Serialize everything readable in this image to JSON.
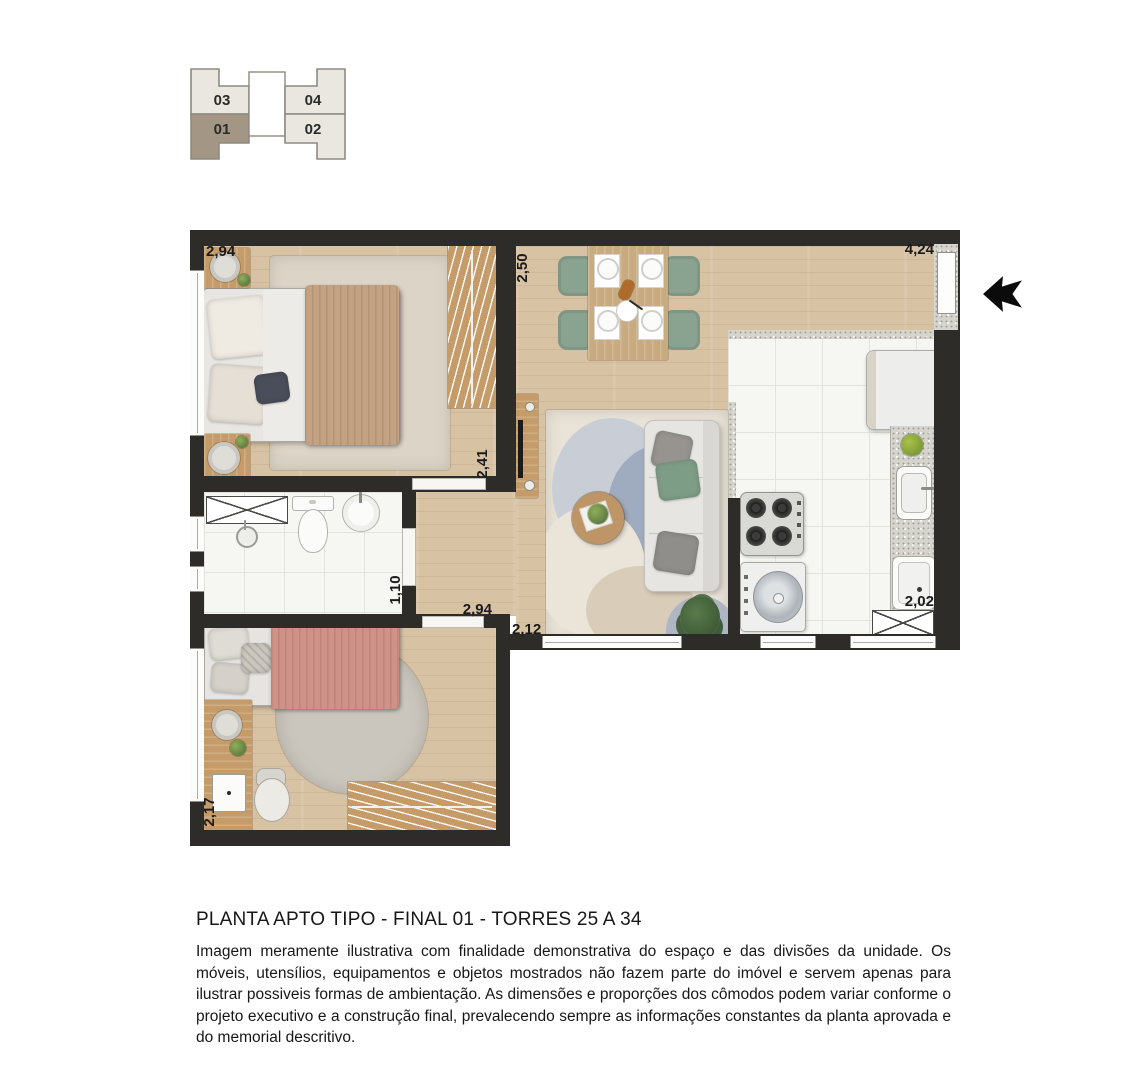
{
  "key_plan": {
    "units": [
      {
        "id": "03",
        "label": "03",
        "highlighted": false
      },
      {
        "id": "04",
        "label": "04",
        "highlighted": false
      },
      {
        "id": "01",
        "label": "01",
        "highlighted": true
      },
      {
        "id": "02",
        "label": "02",
        "highlighted": false
      }
    ],
    "highlight_color": "#A49685",
    "unit_color": "#E9E7E0",
    "border_color": "#8E8A81"
  },
  "floor_plan": {
    "dimensions": {
      "bedroom1_width": "2,94",
      "living_width": "2,50",
      "entry_width": "4,24",
      "bedroom1_length": "2,41",
      "bathroom_width": "1,10",
      "bedroom2_width": "2,94",
      "hall_width": "2,12",
      "kitchen_width": "2,02",
      "bedroom2_length": "2,17"
    },
    "colors": {
      "wall": "#2E2C29",
      "wood_floor": "#D8C2A4",
      "tile_floor": "#F6F6F2",
      "chair_green": "#8AA390",
      "blanket_tan": "#C3A284",
      "blanket_pink": "#CE9289"
    }
  },
  "caption": {
    "title": "PLANTA APTO TIPO - FINAL 01 - TORRES 25 A 34",
    "disclaimer": "Imagem meramente ilustrativa com finalidade demonstrativa do espaço e das divisões da unidade. Os móveis, utensílios, equipamentos e objetos mostrados não fazem parte do imóvel e servem apenas para ilustrar possiveis formas de ambientação. As dimensões e proporções dos cômodos podem variar conforme o projeto executivo e a construção final,  prevalecendo sempre as informações constantes da planta aprovada e do memorial descritivo."
  }
}
